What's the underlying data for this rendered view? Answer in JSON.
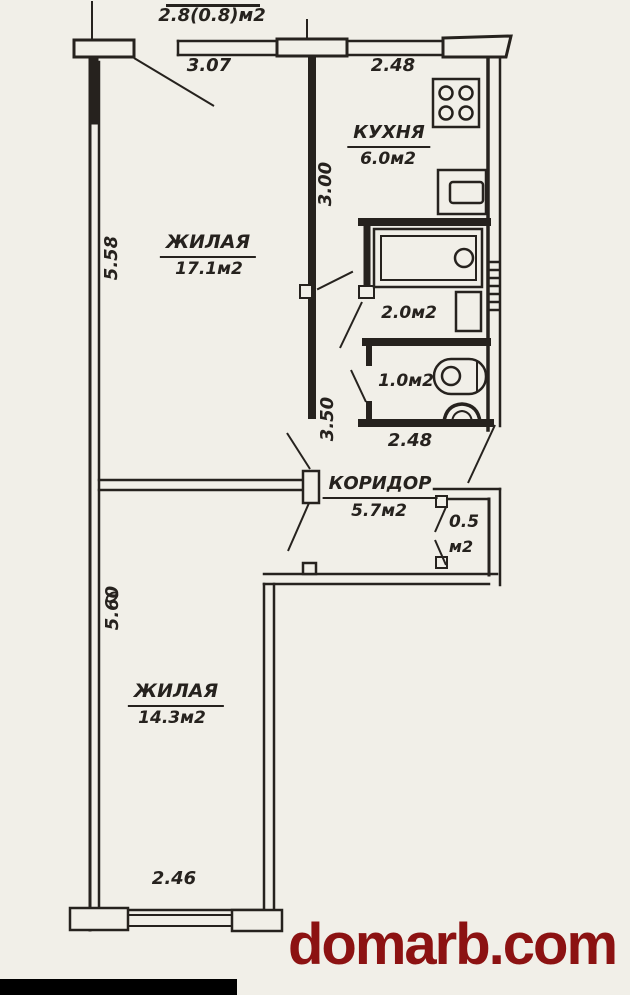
{
  "colors": {
    "paper": "#f1efe8",
    "ink": "#26221e",
    "watermark_red": "#8c1212",
    "bottom_bar": "#000000"
  },
  "watermark": {
    "text": "domarb.com"
  },
  "rooms": {
    "living1": {
      "name": "ЖИЛАЯ",
      "area": "17.1м2"
    },
    "kitchen": {
      "name": "КУХНЯ",
      "area": "6.0м2"
    },
    "corridor": {
      "name": "КОРИДОР",
      "area": "5.7м2"
    },
    "living2": {
      "name": "ЖИЛАЯ",
      "area": "14.3м2"
    },
    "bathroom": {
      "area": "2.0м2"
    },
    "wc": {
      "area": "1.0м2"
    },
    "closet": {
      "area_value": "0.5",
      "area_unit": "м2"
    }
  },
  "dimensions": {
    "balcony_partial": "БАЛКОН",
    "balcony_area": "2.8(0.8)м2",
    "top_window_left": "3.07",
    "top_window_right": "2.48",
    "left_upper": "5.58",
    "center_upper": "3.00",
    "center_lower": "3.50",
    "san_block_width": "2.48",
    "left_lower": "5.60",
    "bottom_window": "2.46"
  },
  "icons": {
    "stove": "svg-shape",
    "kitchen_sink": "svg-shape",
    "bathtub": "svg-shape",
    "washbasin": "svg-shape",
    "toilet": "svg-shape",
    "floor_drain": "svg-shape"
  }
}
